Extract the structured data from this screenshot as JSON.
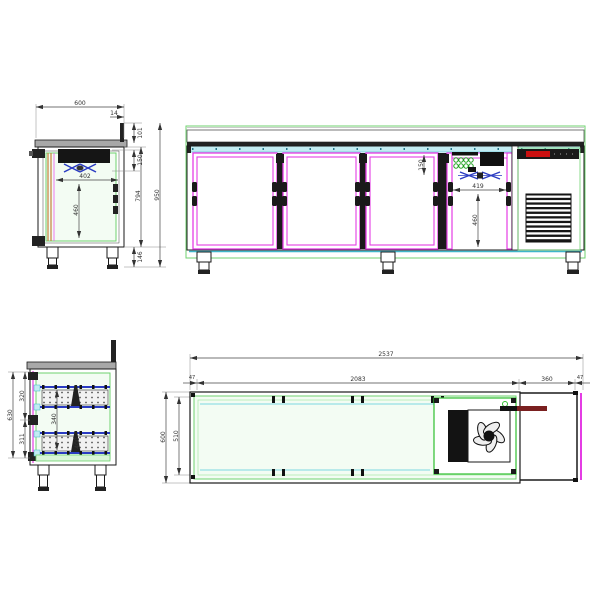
{
  "drawing": {
    "kind": "refrigerated counter technical drawing, four orthographic views",
    "colors": {
      "outline_green": "#6fd26f",
      "pale_green_fill": "#f3fcf3",
      "magenta": "#e43ce4",
      "cyan_fill": "#c2ecf2",
      "cyan_stroke": "#3db6c9",
      "blue": "#2a3bc2",
      "orange": "#c4803a",
      "red_display": "#cc1111",
      "dark_red_rod": "#7a2020",
      "black": "#1a1a1a",
      "worktop_gray": "#a8a8a8"
    }
  },
  "side_section": {
    "top_width": "600",
    "splash_offset": "14",
    "splash_height": "101",
    "evap_zone": "150",
    "inner_width": "402",
    "inner_height": "460",
    "body_height": "794",
    "total_height": "950",
    "leg_height": "146"
  },
  "front_view": {
    "evap_zone": "150",
    "inner_width": "419",
    "inner_height": "460"
  },
  "drawer_section": {
    "upper_opening": "320",
    "lower_opening": "311",
    "total_opening": "630",
    "inner_top": "340",
    "inner_bottom": "400"
  },
  "plan_view": {
    "total_length": "2537",
    "body_length": "2083",
    "left_end": "47",
    "extension_length": "360",
    "right_end": "47",
    "depth": "600",
    "inner_depth": "510"
  }
}
